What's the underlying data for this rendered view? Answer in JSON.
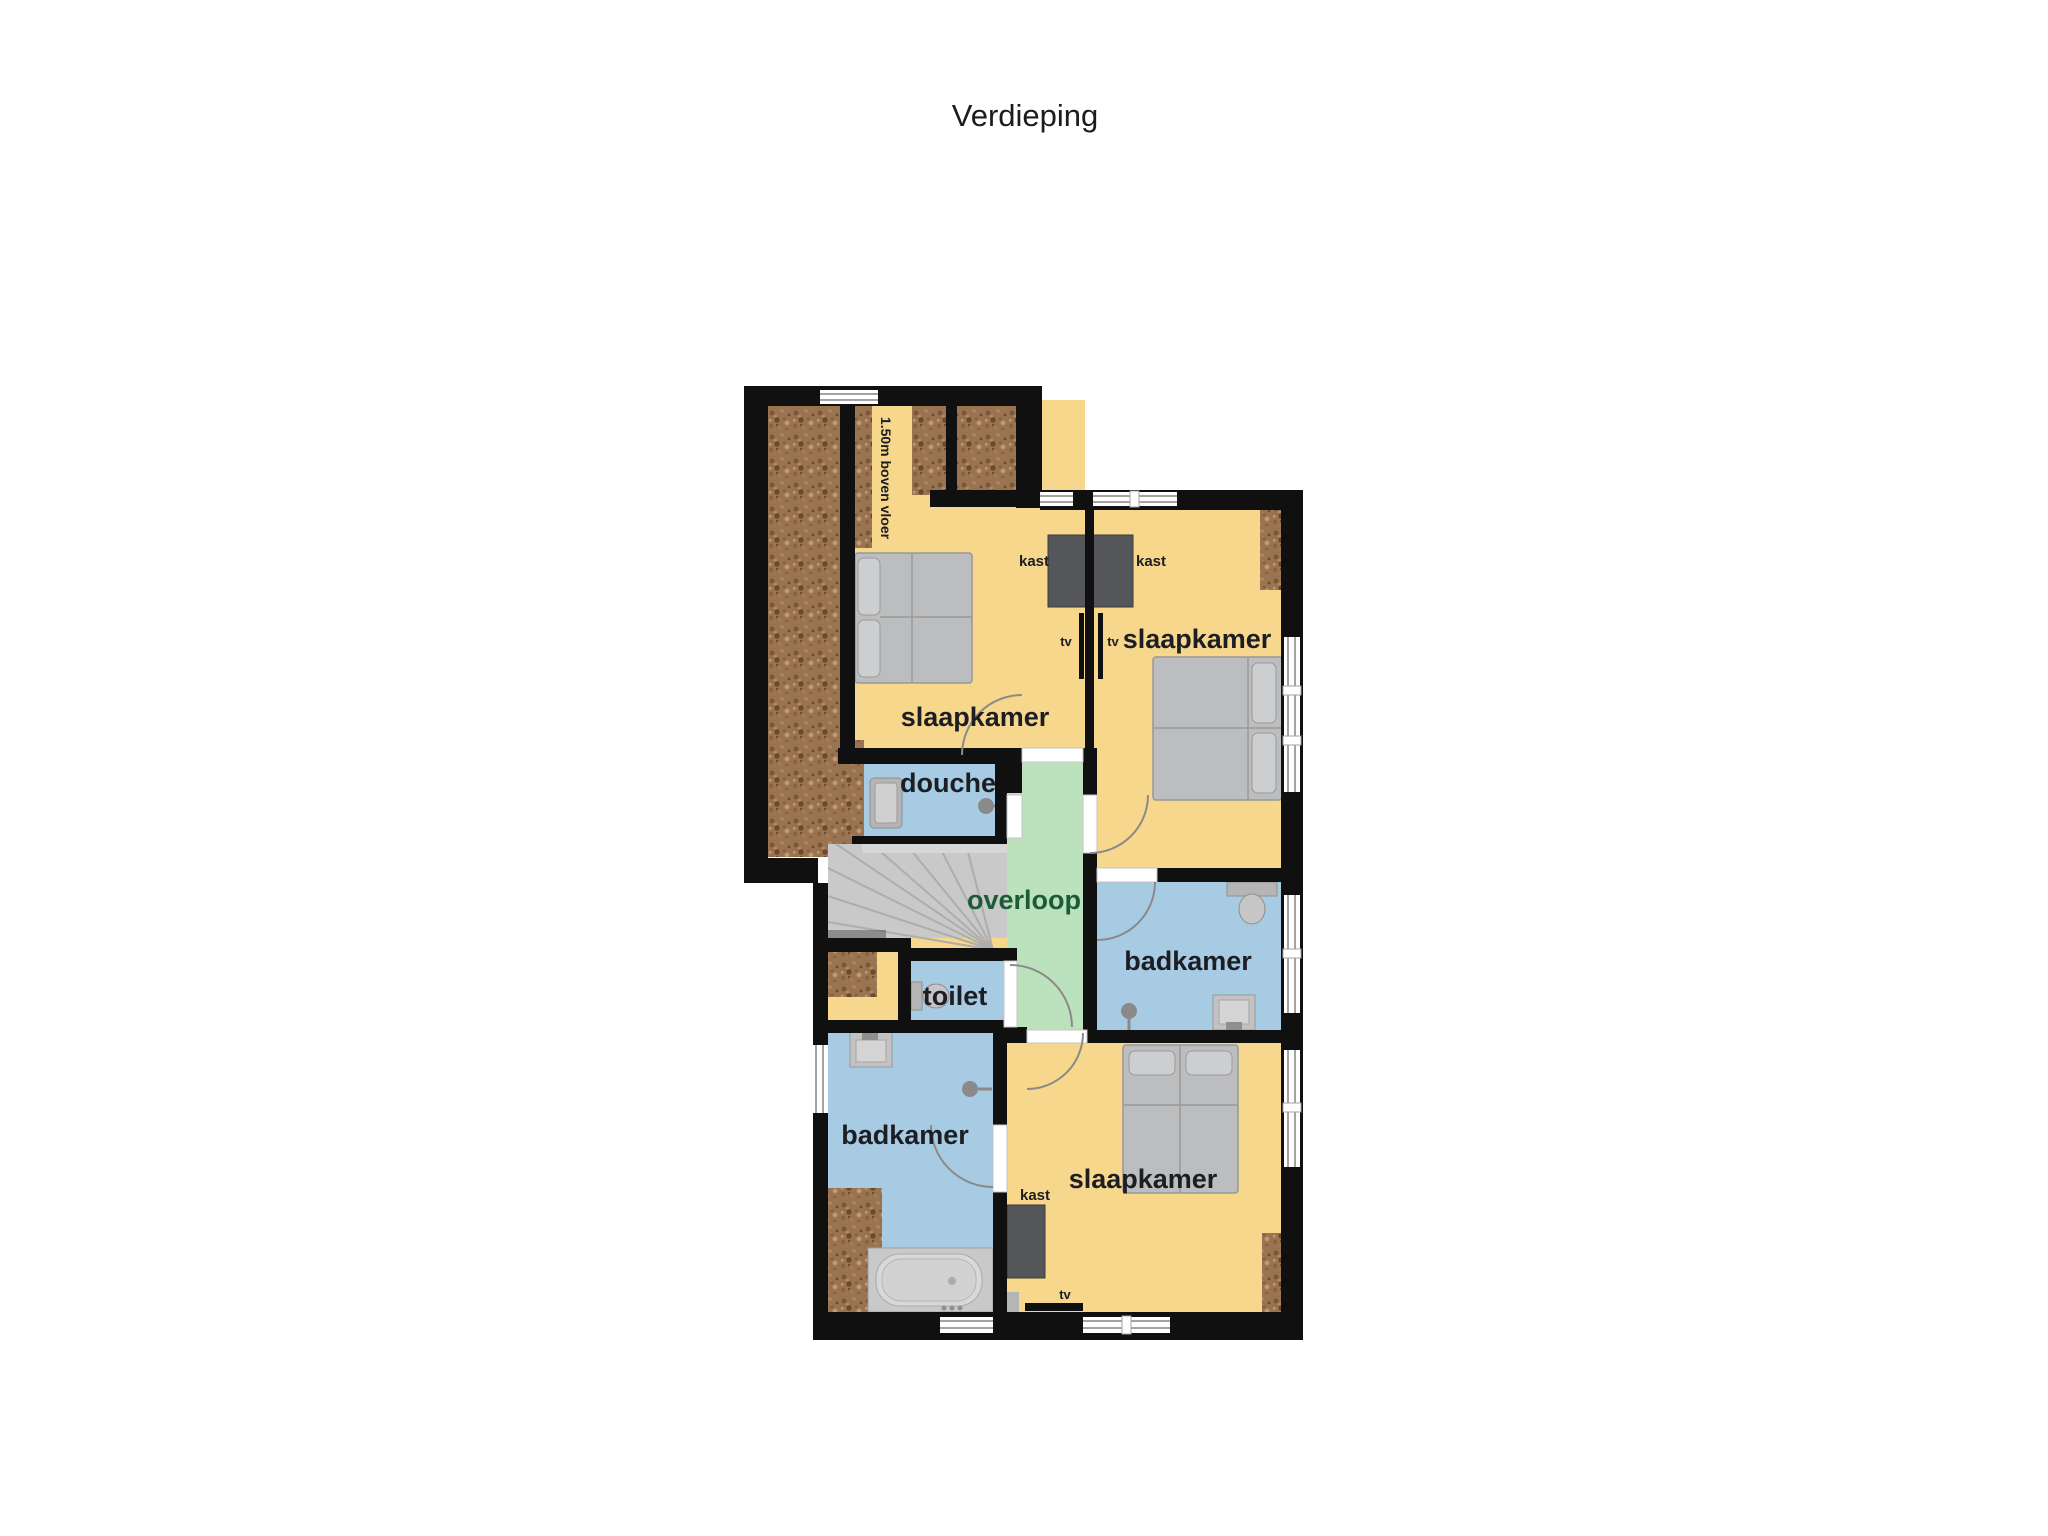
{
  "title": "Verdieping",
  "floor_plan": {
    "rooms": {
      "bedroom_top_left": {
        "label": "slaapkamer"
      },
      "bedroom_top_right": {
        "label": "slaapkamer"
      },
      "bedroom_bottom": {
        "label": "slaapkamer"
      },
      "shower_room": {
        "label": "douche"
      },
      "landing": {
        "label": "overloop"
      },
      "toilet": {
        "label": "toilet"
      },
      "bathroom_left": {
        "label": "badkamer"
      },
      "bathroom_right": {
        "label": "badkamer"
      }
    },
    "annotations": {
      "closet_top_left": "kast",
      "closet_top_right": "kast",
      "closet_bottom": "kast",
      "tv_top_left": "tv",
      "tv_top_right": "tv",
      "tv_bottom": "tv",
      "knee_wall_note": "1.50m boven vloer"
    },
    "colors": {
      "floor_yellow": "#f6d78b",
      "wet_room_blue": "#a6cbe3",
      "landing_green": "#bce2bd",
      "wall_black": "#101010",
      "furniture_gray": "#bcbdbf",
      "closet_dark": "#55565a",
      "attic_brown": "#9a7450",
      "stairs_gray": "#c9c9c9",
      "label_dark": "#1d1d24",
      "landing_label_green": "#1c5b38"
    }
  }
}
